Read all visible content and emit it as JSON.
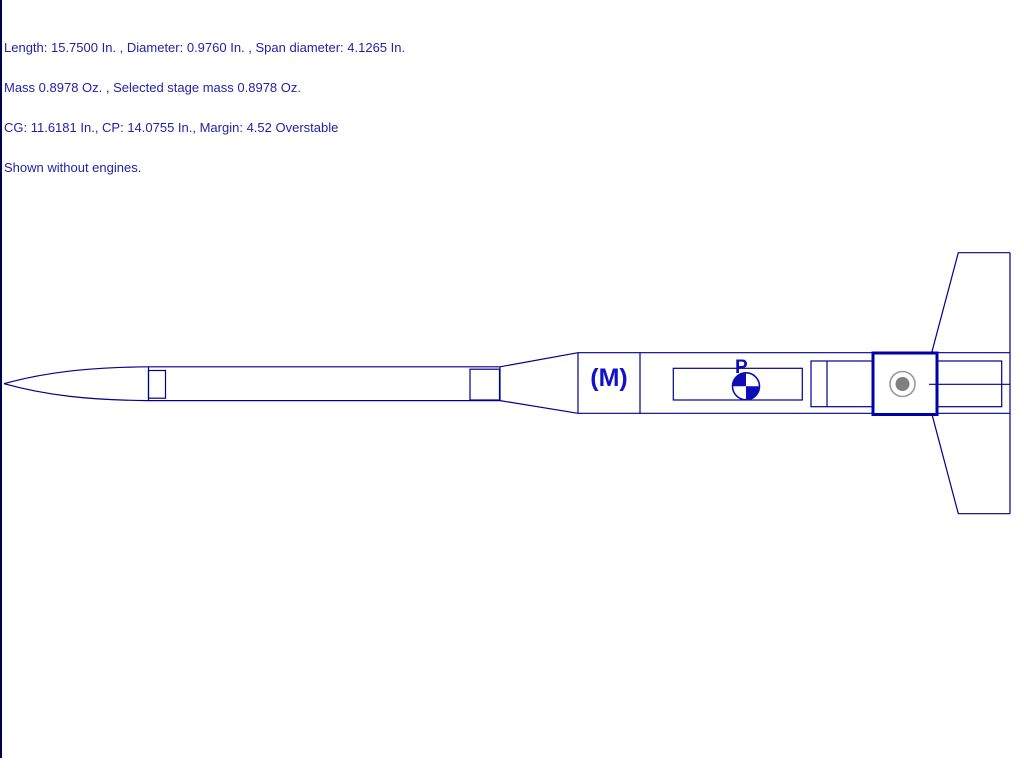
{
  "header": {
    "lines": [
      "Length: 15.7500 In. , Diameter: 0.9760 In. , Span diameter: 4.1265 In.",
      "Mass 0.8978 Oz. , Selected stage mass 0.8978 Oz.",
      "CG: 11.6181 In., CP: 14.0755 In., Margin: 4.52 Overstable",
      "Shown without engines."
    ],
    "text_color": "#2222AA"
  },
  "measurements": {
    "length_in": "15.7500",
    "diameter_in": "0.9760",
    "span_diameter_in": "4.1265",
    "mass_oz": "0.8978",
    "selected_stage_mass_oz": "0.8978",
    "cg_in": "11.6181",
    "cp_in": "14.0755",
    "margin": "4.52",
    "stability_text": "Overstable"
  },
  "diagram": {
    "motor_tube_label": "(M)",
    "cg_flag_label": "P",
    "line_color": "#00008B",
    "selection_color": "#0000A8",
    "cg_fill_color": "#0D0DB8",
    "cp_ring_color": "#9A9A9A",
    "cp_dot_color": "#808080",
    "background": "#FFFFFF"
  }
}
